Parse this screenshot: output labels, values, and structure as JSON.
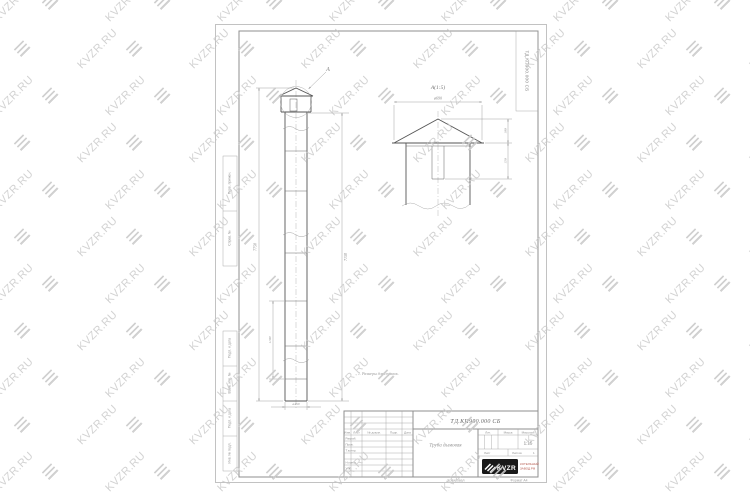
{
  "watermark": {
    "text": "KVZR.RU"
  },
  "colors": {
    "watermark": "#c7c7c7",
    "contour_line": "#565656",
    "dimension_line": "#8a8a8a",
    "logo_bg": "#191919",
    "company_text": "#b4564b"
  },
  "sheet": {
    "corner_stamp": "ТД.КП900.000 СБ",
    "margin_top": [
      "Перв. примен.",
      "Справ. №"
    ],
    "margin_bottom": [
      "Подп. и дата",
      "Взам. инв. №",
      "Подп. и дата",
      "Инв. № подл."
    ],
    "note": "1. Размеры для справок.",
    "main_view": {
      "callout_label": "А",
      "dim_overall": "7750",
      "dim_body": "7150",
      "dim_section": "1190",
      "dim_diameter": "ø450"
    },
    "detail_view": {
      "title": "А(1:5)",
      "dim_diameter": "ø690",
      "dim_roof_height": "100",
      "dim_skirt_height": "150"
    },
    "title_block": {
      "designation": "ТД.КП900.000 СБ",
      "doc_name": "Труба дымовая",
      "header_cols": [
        "Изм.",
        "Лист",
        "№ докум.",
        "Подп.",
        "Дата"
      ],
      "row_labels": [
        "Разраб.",
        "Пров.",
        "Т.контр.",
        "Н.контр.",
        "Утв."
      ],
      "lit_label": "Лит.",
      "mass_label": "Масса",
      "scale_label": "Масштаб",
      "scale_value": "1:15",
      "sheet_label": "Лист",
      "sheets_label": "Листов",
      "sheets_value": "1",
      "logo_text": "KVZR",
      "company_lines": [
        "КОТЕЛЬНЫЙ",
        "ЗАВОД.РФ"
      ],
      "copied_label": "Копировал",
      "format_label": "Формат А4"
    }
  }
}
